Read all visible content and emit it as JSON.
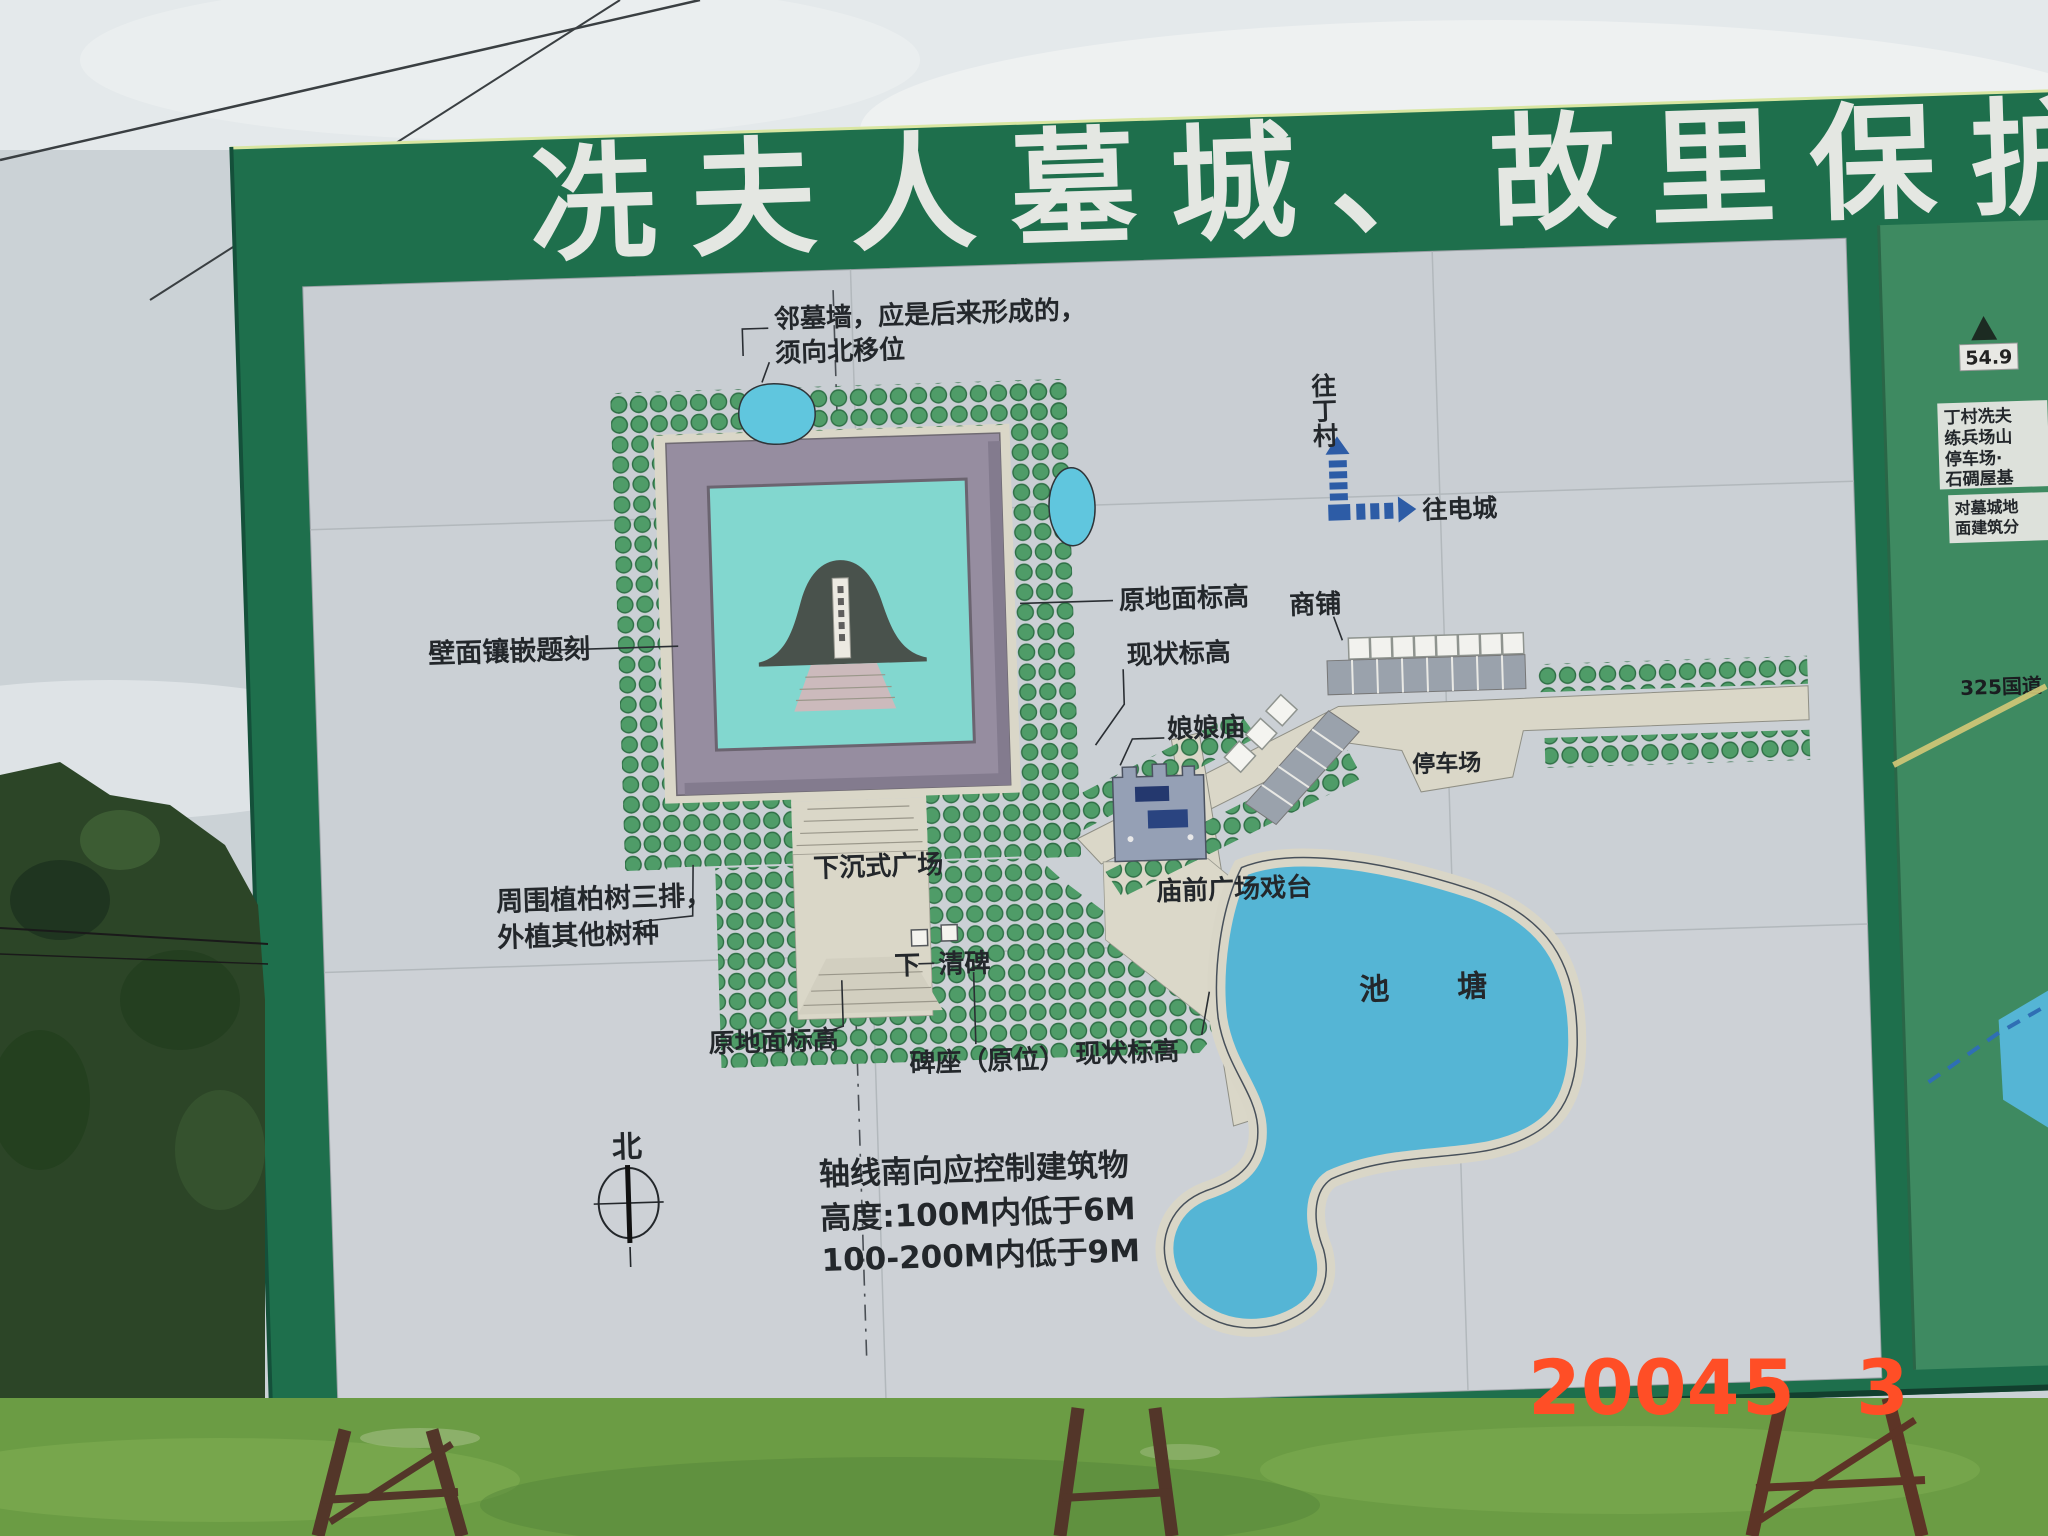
{
  "billboard": {
    "title": "冼夫人墓城、故里保护"
  },
  "map": {
    "labels": {
      "top_note_line1": "邻墓墙，应是后来形成的，",
      "top_note_line2": "须向北移位",
      "to_dingcun": "往丁村",
      "to_diancheng": "往电城",
      "orig_ground_right": "原地面标高",
      "current_level_right": "现状标高",
      "shops": "商铺",
      "temple": "娘娘庙",
      "parking": "停车场",
      "wall_inscription": "壁面镶嵌题刻",
      "trees_note_line1": "周围植柏树三排，",
      "trees_note_line2": "外植其他树种",
      "sunken_plaza": "下沉式广场",
      "temple_plaza": "庙前广场戏台",
      "pond": "池塘",
      "xia": "下",
      "qingbei": "清碑",
      "orig_ground_bottom": "原地面标高",
      "pedestal": "碑座（原位）",
      "current_level_bottom": "现状标高",
      "north": "北",
      "height_note_line1": "轴线南向应控制建筑物",
      "height_note_line2": "高度:100M内低于6M",
      "height_note_line3": "100-200M内低于9M"
    }
  },
  "inset": {
    "elevation": "54.9",
    "box1_lines": [
      "丁村冼夫",
      "练兵场山",
      "停车场·",
      "石碉屋基"
    ],
    "box2_lines": [
      "对墓城地",
      "面建筑分"
    ],
    "road": "325国道"
  },
  "timestamp": {
    "year": "2004",
    "month": "5",
    "day": "3"
  },
  "colors": {
    "board_green": "#1e6f4c",
    "inset_green": "#3e8a61",
    "panel_gray": "#c9ced3",
    "tree_dot": "#4f9c68",
    "water_blue": "#55b5d5",
    "small_pond_blue": "#60c6de",
    "courtyard_teal": "#82d7cf",
    "path_cream": "#dad7c8",
    "wall_gray": "#968da0",
    "mound_gray": "#49524c",
    "arrow_blue": "#2d5ca6",
    "timestamp_orange": "#ff4e26",
    "title_white": "#e4e7e2",
    "label_dark": "#23272b"
  }
}
